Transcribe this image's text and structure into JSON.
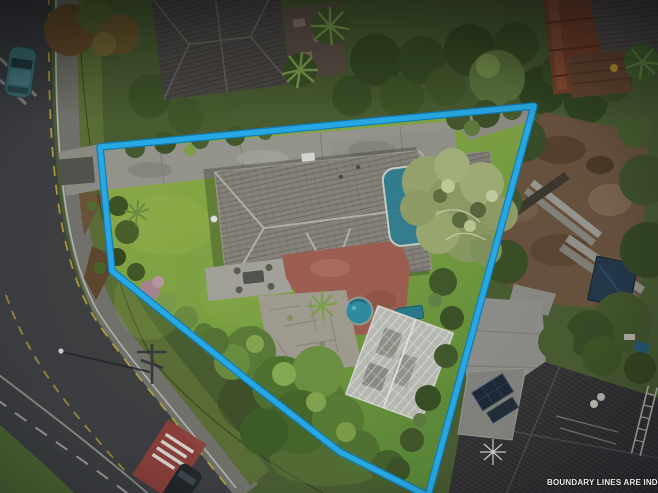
{
  "meta": {
    "type": "aerial-drone-photograph",
    "subject": "residential corner property with boundary overlay"
  },
  "overlay": {
    "disclaimer_text": "BOUNDARY LINES ARE INDICATIVE",
    "boundary_points": "100,147 534,106 428,496 340,452 250,382 112,271",
    "boundary_color": "#29ACE8",
    "boundary_underlay_color": "#0F7FBE",
    "disclaimer_color": "#E9E7E3"
  },
  "palette": {
    "lawn_light": "#93B04A",
    "lawn_dark": "#5C8A3A",
    "roof_main": "#87837C",
    "roof_ridge": "#B3AFA7",
    "driveway": "#98978F",
    "road": "#3E4043",
    "footpath": "#74756E",
    "verge_green": "#5C7038",
    "patio_red": "#9C5E50",
    "paving_grey": "#A09C8F",
    "pool_teal": "#2E8DA0",
    "greenhouse": "#B9BCB4",
    "construction_dirt": "#6A5440",
    "dark_roof": "#323234",
    "marking_yellow": "#C7AB3A",
    "marking_white": "#D8D5CD",
    "tarp_blue": "#263A4E",
    "car_teal": "#3E7077"
  },
  "scene_features": [
    "curved suburban road with yellow and white markings",
    "parked teal car top-left",
    "cyan property boundary outline",
    "concrete driveway along top boundary",
    "large grey hip-roof house",
    "round teal spa pool on red patio",
    "flagstone paving",
    "white-framed greenhouse",
    "large pale-green overhanging tree",
    "construction dirt area with planks and blue tarp at right",
    "dark tiled neighbour roof with solar panels bottom-right",
    "red road marking with white lettering on lower road"
  ]
}
